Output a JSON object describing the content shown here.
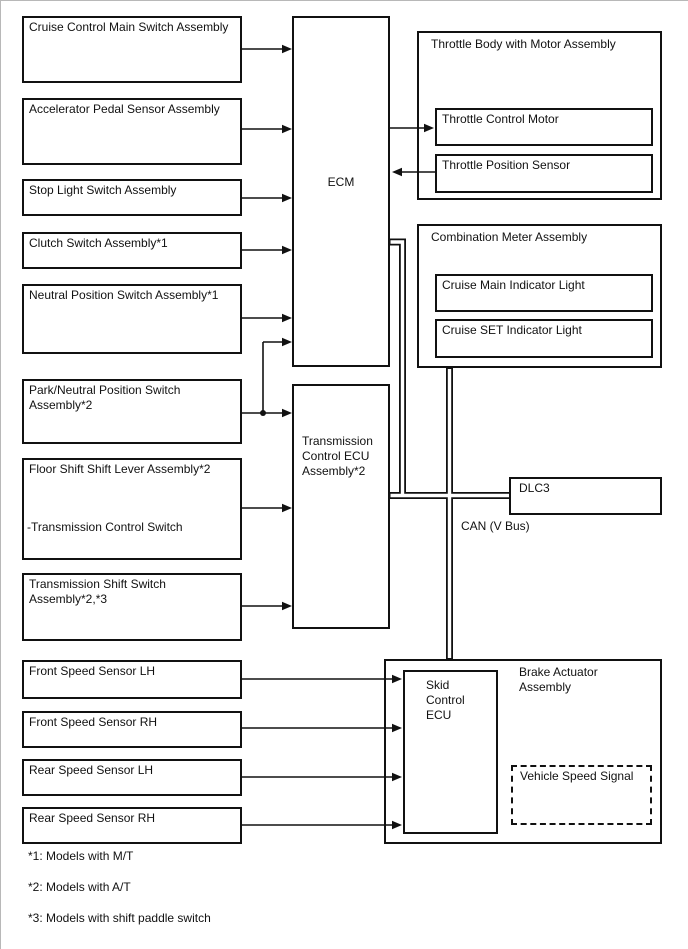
{
  "page": {
    "background": "#ffffff",
    "line_color": "#111111"
  },
  "nodes": {
    "cruise_main_switch": {
      "label": "Cruise Control Main Switch Assembly"
    },
    "accel_pedal_sensor": {
      "label": "Accelerator Pedal Sensor Assembly"
    },
    "stop_light_switch": {
      "label": "Stop Light Switch Assembly"
    },
    "clutch_switch": {
      "label": "Clutch Switch Assembly*1"
    },
    "neutral_position_switch": {
      "label": "Neutral Position Switch Assembly*1"
    },
    "park_neutral_switch": {
      "label": "Park/Neutral Position Switch Assembly*2"
    },
    "floor_shift_lever": {
      "label": "Floor Shift Shift Lever Assembly*2",
      "sublabel": "-Transmission Control Switch"
    },
    "trans_shift_switch": {
      "label": "Transmission Shift Switch Assembly*2,*3"
    },
    "front_speed_lh": {
      "label": "Front Speed Sensor LH"
    },
    "front_speed_rh": {
      "label": "Front Speed Sensor RH"
    },
    "rear_speed_lh": {
      "label": "Rear Speed Sensor LH"
    },
    "rear_speed_rh": {
      "label": "Rear Speed Sensor RH"
    },
    "ecm": {
      "label": "ECM"
    },
    "trans_ecu": {
      "label": "Transmission Control ECU Assembly*2"
    },
    "throttle_body": {
      "label": "Throttle Body with Motor Assembly"
    },
    "throttle_motor": {
      "label": "Throttle Control Motor"
    },
    "throttle_sensor": {
      "label": "Throttle Position Sensor"
    },
    "combo_meter": {
      "label": "Combination Meter Assembly"
    },
    "cruise_main_light": {
      "label": "Cruise Main Indicator Light"
    },
    "cruise_set_light": {
      "label": "Cruise SET Indicator Light"
    },
    "dlc3": {
      "label": "DLC3"
    },
    "brake_actuator": {
      "label": "Brake Actuator Assembly"
    },
    "skid_ecu": {
      "label": "Skid Control ECU"
    },
    "vehicle_speed_signal": {
      "label": "Vehicle Speed Signal"
    }
  },
  "bus_label": "CAN (V Bus)",
  "footnotes": [
    "*1: Models with M/T",
    "*2: Models with A/T",
    "*3: Models with shift paddle switch"
  ]
}
